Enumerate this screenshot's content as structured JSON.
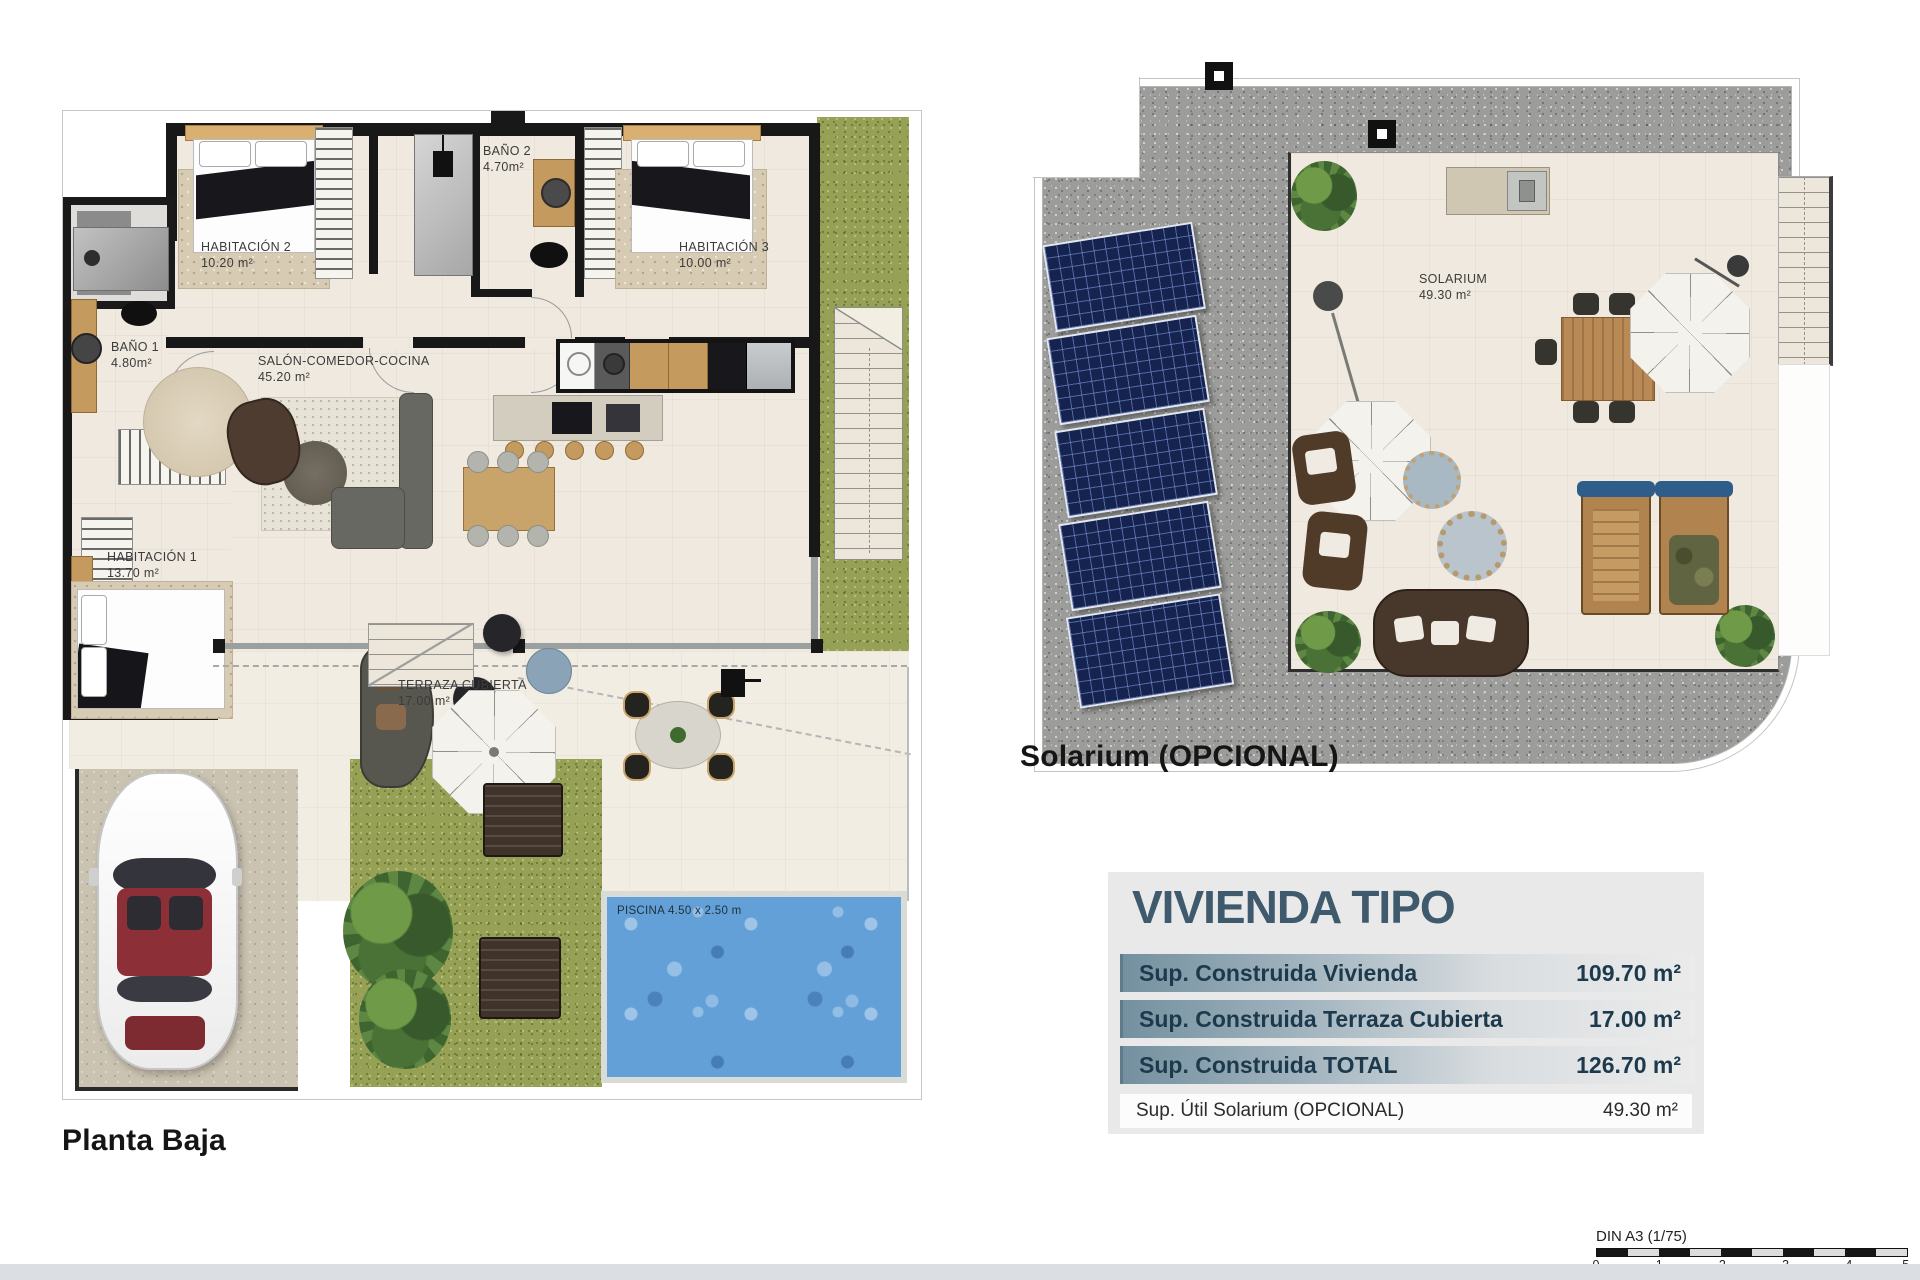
{
  "plan_ground": {
    "caption": "Planta Baja",
    "rooms": {
      "habitacion2": {
        "name": "HABITACIÓN 2",
        "area": "10.20 m²"
      },
      "bano2": {
        "name": "BAÑO 2",
        "area": "4.70m²"
      },
      "habitacion3": {
        "name": "HABITACIÓN 3",
        "area": "10.00 m²"
      },
      "bano1": {
        "name": "BAÑO 1",
        "area": "4.80m²"
      },
      "salon": {
        "name": "SALÓN-COMEDOR-COCINA",
        "area": "45.20 m²"
      },
      "habitacion1": {
        "name": "HABITACIÓN 1",
        "area": "13.70 m²"
      },
      "terraza": {
        "name": "TERRAZA CUBIERTA",
        "area": "17.00 m²"
      }
    },
    "pool_label": "PISCINA 4.50 x 2.50 m"
  },
  "plan_solarium": {
    "caption": "Solarium (OPCIONAL)",
    "room": {
      "name": "SOLARIUM",
      "area": "49.30 m²"
    }
  },
  "summary": {
    "title": "VIVIENDA TIPO",
    "rows": [
      {
        "label": "Sup. Construida Vivienda",
        "value": "109.70 m²"
      },
      {
        "label": "Sup. Construida Terraza Cubierta",
        "value": "17.00 m²"
      },
      {
        "label": "Sup. Construida TOTAL",
        "value": "126.70 m²"
      }
    ],
    "note_row": {
      "label": "Sup. Útil Solarium (OPCIONAL)",
      "value": "49.30 m²"
    }
  },
  "scale_bar": {
    "label": "DIN A3 (1/75)",
    "ticks": [
      "0",
      "1",
      "2",
      "3",
      "4",
      "5"
    ]
  },
  "colors": {
    "accent_title": "#3e5a6c",
    "row_gradient_start": "#74909f",
    "pool": "#63a0d8",
    "grass": "#97a155",
    "gravel": "#9c9c9a",
    "solar_panel": "#16234f"
  }
}
